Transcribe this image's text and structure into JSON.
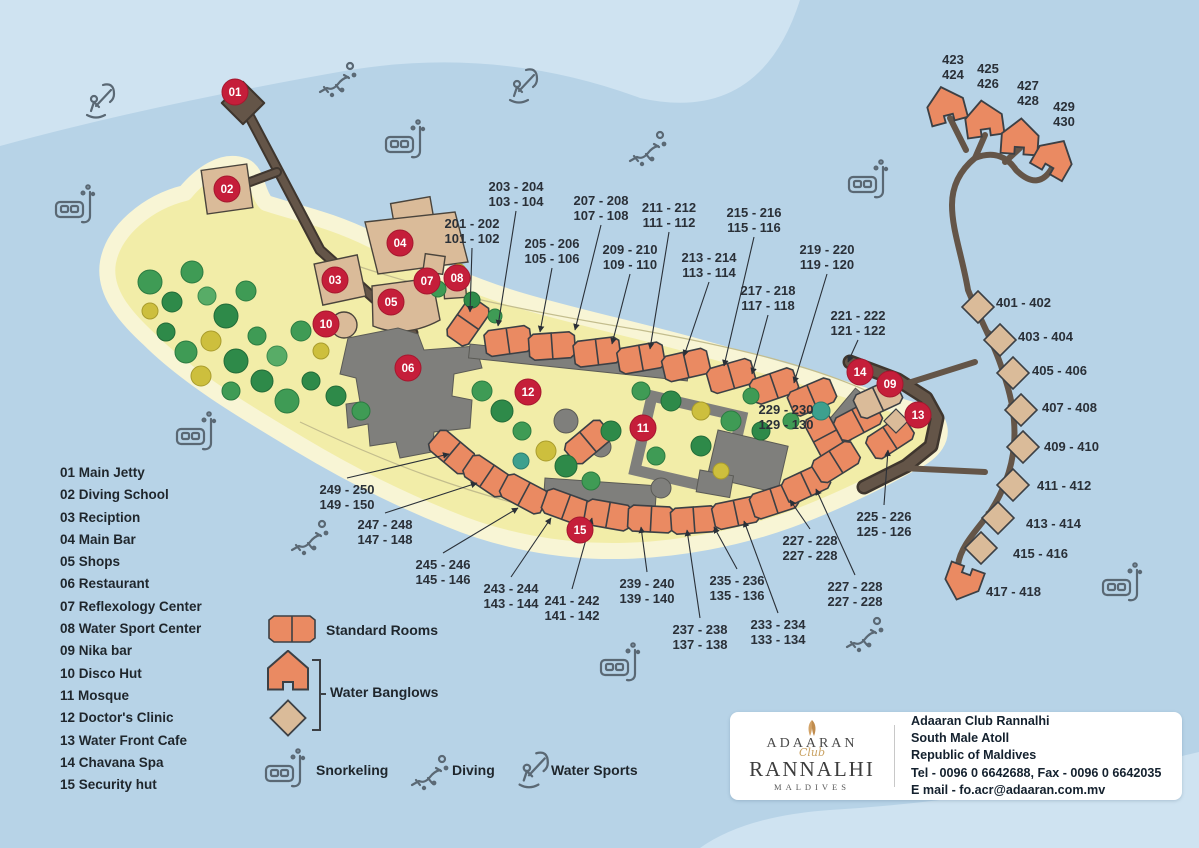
{
  "palette": {
    "water": "#b7d3e7",
    "water_light": "#cfe3f1",
    "sand": "#f2eda8",
    "beach": "#f8f5d5",
    "room_orange": "#ea8a62",
    "bungalow_tan": "#dabb99",
    "building_gray": "#7f7f7c",
    "jetty_brown": "#645548",
    "marker_red": "#c51e3a",
    "label_text": "#2a3038",
    "icon_stroke": "#5a6874"
  },
  "facilities": [
    "01 Main Jetty",
    "02 Diving School",
    "03 Reciption",
    "04 Main Bar",
    "05 Shops",
    "06 Restaurant",
    "07 Reflexology Center",
    "08 Water Sport Center",
    "09 Nika bar",
    "10 Disco Hut",
    "11 Mosque",
    "12 Doctor's Clinic",
    "13 Water Front Cafe",
    "14 Chavana Spa",
    "15 Security hut"
  ],
  "legend": {
    "standard_rooms": "Standard Rooms",
    "water_bungalows": "Water Banglows",
    "snorkeling": "Snorkeling",
    "diving": "Diving",
    "water_sports": "Water Sports"
  },
  "contact": {
    "logo_line1": "ADAARAN",
    "logo_script": "Club",
    "logo_line2": "RANNALHI",
    "logo_line3": "MALDIVES",
    "name": "Adaaran Club Rannalhi",
    "address1": "South Male Atoll",
    "address2": "Republic of Maldives",
    "tel_fax": "Tel - 0096 0 6642688, Fax - 0096 0 6642035",
    "email": "E mail - fo.acr@adaaran.com.mv"
  },
  "map": {
    "markers": [
      {
        "n": "01",
        "x": 235,
        "y": 92
      },
      {
        "n": "02",
        "x": 227,
        "y": 189
      },
      {
        "n": "03",
        "x": 335,
        "y": 280
      },
      {
        "n": "04",
        "x": 400,
        "y": 243
      },
      {
        "n": "05",
        "x": 391,
        "y": 302
      },
      {
        "n": "06",
        "x": 408,
        "y": 368
      },
      {
        "n": "07",
        "x": 427,
        "y": 281
      },
      {
        "n": "08",
        "x": 457,
        "y": 278
      },
      {
        "n": "09",
        "x": 890,
        "y": 384
      },
      {
        "n": "10",
        "x": 326,
        "y": 324
      },
      {
        "n": "11",
        "x": 643,
        "y": 428
      },
      {
        "n": "12",
        "x": 528,
        "y": 392
      },
      {
        "n": "13",
        "x": 918,
        "y": 415
      },
      {
        "n": "14",
        "x": 860,
        "y": 372
      },
      {
        "n": "15",
        "x": 580,
        "y": 530
      }
    ],
    "room_labels": [
      {
        "x": 472,
        "y": 228,
        "lines": [
          "201 - 202",
          "101 - 102"
        ],
        "to": [
          470,
          312
        ]
      },
      {
        "x": 516,
        "y": 191,
        "lines": [
          "203 - 204",
          "103 - 104"
        ],
        "to": [
          498,
          326
        ]
      },
      {
        "x": 552,
        "y": 248,
        "lines": [
          "205 - 206",
          "105 - 106"
        ],
        "to": [
          540,
          332
        ]
      },
      {
        "x": 601,
        "y": 205,
        "lines": [
          "207 - 208",
          "107 - 108"
        ],
        "to": [
          575,
          330
        ]
      },
      {
        "x": 630,
        "y": 254,
        "lines": [
          "209 - 210",
          "109 - 110"
        ],
        "to": [
          612,
          344
        ]
      },
      {
        "x": 669,
        "y": 212,
        "lines": [
          "211 - 212",
          "111 - 112"
        ],
        "to": [
          650,
          349
        ]
      },
      {
        "x": 709,
        "y": 262,
        "lines": [
          "213 - 214",
          "113 - 114"
        ],
        "to": [
          684,
          356
        ]
      },
      {
        "x": 754,
        "y": 217,
        "lines": [
          "215 - 216",
          "115 - 116"
        ],
        "to": [
          724,
          366
        ]
      },
      {
        "x": 768,
        "y": 295,
        "lines": [
          "217 - 218",
          "117 - 118"
        ],
        "to": [
          752,
          374
        ]
      },
      {
        "x": 827,
        "y": 254,
        "lines": [
          "219 - 220",
          "119 - 120"
        ],
        "to": [
          794,
          383
        ]
      },
      {
        "x": 858,
        "y": 320,
        "lines": [
          "221 - 222",
          "121 - 122"
        ],
        "to": [
          848,
          362
        ]
      },
      {
        "x": 786,
        "y": 414,
        "lines": [
          "229 - 230",
          "129 - 130"
        ]
      },
      {
        "x": 884,
        "y": 521,
        "lines": [
          "225 - 226",
          "125 - 126"
        ],
        "to": [
          888,
          450
        ]
      },
      {
        "x": 810,
        "y": 545,
        "lines": [
          "227 - 228",
          "227 - 228"
        ],
        "to": [
          790,
          500
        ]
      },
      {
        "x": 855,
        "y": 591,
        "lines": [
          "227 - 228",
          "227 - 228"
        ],
        "to": [
          816,
          489
        ]
      },
      {
        "x": 778,
        "y": 629,
        "lines": [
          "233 - 234",
          "133 - 134"
        ],
        "to": [
          744,
          521
        ]
      },
      {
        "x": 737,
        "y": 585,
        "lines": [
          "235 - 236",
          "135 - 136"
        ],
        "to": [
          714,
          527
        ]
      },
      {
        "x": 700,
        "y": 634,
        "lines": [
          "237 - 238",
          "137 - 138"
        ],
        "to": [
          687,
          530
        ]
      },
      {
        "x": 647,
        "y": 588,
        "lines": [
          "239 - 240",
          "139 - 140"
        ],
        "to": [
          641,
          527
        ]
      },
      {
        "x": 572,
        "y": 605,
        "lines": [
          "241 - 242",
          "141 - 142"
        ],
        "to": [
          592,
          518
        ]
      },
      {
        "x": 511,
        "y": 593,
        "lines": [
          "243 - 244",
          "143 - 144"
        ],
        "to": [
          551,
          518
        ]
      },
      {
        "x": 443,
        "y": 569,
        "lines": [
          "245 - 246",
          "145 - 146"
        ],
        "to": [
          518,
          508
        ]
      },
      {
        "x": 385,
        "y": 529,
        "lines": [
          "247 - 248",
          "147 - 148"
        ],
        "to": [
          477,
          483
        ]
      },
      {
        "x": 347,
        "y": 494,
        "lines": [
          "249 - 250",
          "149 - 150"
        ],
        "to": [
          449,
          454
        ]
      },
      {
        "x": 953,
        "y": 64,
        "lines": [
          "423",
          "424"
        ]
      },
      {
        "x": 988,
        "y": 73,
        "lines": [
          "425",
          "426"
        ]
      },
      {
        "x": 1028,
        "y": 90,
        "lines": [
          "427",
          "428"
        ]
      },
      {
        "x": 1064,
        "y": 111,
        "lines": [
          "429",
          "430"
        ]
      },
      {
        "x": 996,
        "y": 307,
        "anchor": "s",
        "lines": [
          "401 - 402"
        ]
      },
      {
        "x": 1018,
        "y": 341,
        "anchor": "s",
        "lines": [
          "403 - 404"
        ]
      },
      {
        "x": 1032,
        "y": 375,
        "anchor": "s",
        "lines": [
          "405 - 406"
        ]
      },
      {
        "x": 1042,
        "y": 412,
        "anchor": "s",
        "lines": [
          "407 - 408"
        ]
      },
      {
        "x": 1044,
        "y": 451,
        "anchor": "s",
        "lines": [
          "409 - 410"
        ]
      },
      {
        "x": 1037,
        "y": 490,
        "anchor": "s",
        "lines": [
          "411 - 412"
        ]
      },
      {
        "x": 1026,
        "y": 528,
        "anchor": "s",
        "lines": [
          "413 - 414"
        ]
      },
      {
        "x": 1013,
        "y": 558,
        "anchor": "s",
        "lines": [
          "415 - 416"
        ]
      },
      {
        "x": 986,
        "y": 596,
        "anchor": "s",
        "lines": [
          "417 - 418"
        ]
      }
    ],
    "activity_icons": [
      {
        "type": "kitesurf",
        "x": 95,
        "y": 100
      },
      {
        "type": "snorkel",
        "x": 75,
        "y": 205
      },
      {
        "type": "diving",
        "x": 335,
        "y": 78
      },
      {
        "type": "snorkel",
        "x": 405,
        "y": 140
      },
      {
        "type": "kitesurf",
        "x": 518,
        "y": 85
      },
      {
        "type": "diving",
        "x": 645,
        "y": 147
      },
      {
        "type": "snorkel",
        "x": 868,
        "y": 180
      },
      {
        "type": "snorkel",
        "x": 196,
        "y": 432
      },
      {
        "type": "diving",
        "x": 307,
        "y": 536
      },
      {
        "type": "snorkel",
        "x": 620,
        "y": 663
      },
      {
        "type": "diving",
        "x": 862,
        "y": 633
      },
      {
        "type": "snorkel",
        "x": 1122,
        "y": 583
      }
    ]
  }
}
